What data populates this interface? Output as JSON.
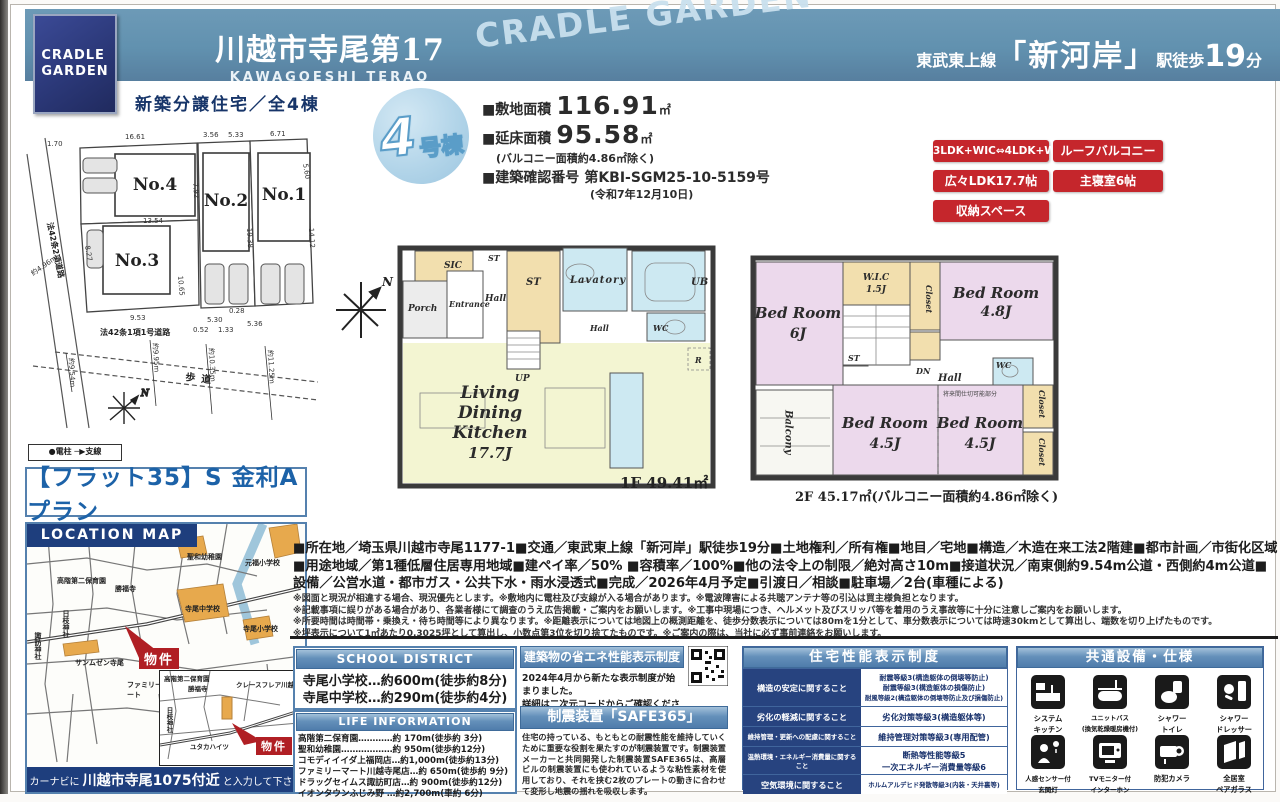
{
  "header": {
    "logo_line1": "CRADLE",
    "logo_line2": "GARDEN",
    "title": "川越市寺尾第17",
    "subtitle": "KAWAGOESHI TERAO",
    "watermark": "CRADLE GARDEN",
    "station_line": "東武東上線",
    "station_open": "「",
    "station_name": "新河岸",
    "station_close": "」",
    "station_walk": "駅徒歩",
    "station_min": "19",
    "station_min_unit": "分"
  },
  "subheader": "新築分譲住宅／全4棟",
  "unit_badge": {
    "number": "4",
    "suffix": "号棟"
  },
  "specs": {
    "land_label": "■敷地面積",
    "land_value": "116.91",
    "land_unit": "㎡",
    "floor_label": "■延床面積",
    "floor_value": "95.58",
    "floor_unit": "㎡",
    "balcony_note": "(バルコニー面積約4.86㎡除く)",
    "confirm_label": "■建築確認番号",
    "confirm_value": "第KBI-SGM25-10-5159号",
    "confirm_date": "(令和7年12月10日)"
  },
  "feature_badges": [
    "3LDK+WIC⇔4LDK+WIC",
    "ルーフバルコニー",
    "広々LDK17.7帖",
    "主寝室6帖",
    "収納スペース"
  ],
  "site_plan": {
    "lots": [
      "No.1",
      "No.2",
      "No.3",
      "No.4"
    ],
    "roads": [
      "法42条2項道路",
      "法42条1項1号道路",
      "歩道"
    ],
    "dims": {
      "d1": "1.70",
      "d2": "16.61",
      "d3": "3.56",
      "d4": "5.33",
      "d5": "6.71",
      "d6": "13.54",
      "d7": "7.92",
      "d8": "8.27",
      "d9": "10.65",
      "d10": "19.38",
      "d11": "14.12",
      "d12": "5.60",
      "d13": "9.53",
      "d14": "5.30",
      "d15": "0.52",
      "d16": "1.33",
      "d17": "5.36",
      "d18": "0.28",
      "w1": "約4.96m",
      "w2": "約9.54m",
      "w3": "約9.95m",
      "w4": "約10.35m",
      "w5": "約11.25m"
    },
    "legend": "●電柱 ─▶支線",
    "north": "N"
  },
  "flat35": "【フラット35】S 金利Aプラン",
  "location_map": {
    "header": "LOCATION MAP",
    "landmarks": {
      "l1": "聖和幼稚園",
      "l2": "元福小学校",
      "l3": "高階第二保育園",
      "l4": "勝福寺",
      "l5": "日枝神社",
      "l6": "諏訪神社",
      "l7": "サンムゼン寺尾",
      "l8": "寺尾中学校",
      "l9": "寺尾小学校",
      "l10": "ファミリーマート"
    },
    "inset": {
      "i1": "高階第二保育園",
      "i2": "勝福寺",
      "i3": "日枝神社",
      "i4": "クレースフレア川越",
      "i5": "ユタカハイツ"
    },
    "property": "物件",
    "navi_pre": "カーナビに ",
    "navi_addr": "川越市寺尾1075付近",
    "navi_post": " と入力して下さい"
  },
  "plan1f": {
    "label": "1F 49.41㎡",
    "rooms": {
      "sic": "SIC",
      "porch": "Porch",
      "entrance": "Entrance",
      "hall": "Hall",
      "st1": "ST",
      "st2": "ST",
      "lavatory": "Lavatory",
      "ub": "UB",
      "wc": "WC",
      "hall2": "Hall",
      "up": "UP",
      "r": "R",
      "ldk1": "Living",
      "ldk2": "Dining",
      "ldk3": "Kitchen",
      "ldk4": "17.7J"
    }
  },
  "plan2f": {
    "label": "2F 45.17㎡(バルコニー面積約4.86㎡除く)",
    "note": "将来間仕切可能部分",
    "rooms": {
      "br1a": "Bed Room",
      "br1b": "6J",
      "br2a": "Bed Room",
      "br2b": "4.8J",
      "br3a": "Bed Room",
      "br3b": "4.5J",
      "br4a": "Bed Room",
      "br4b": "4.5J",
      "wic": "W.I.C",
      "wic2": "1.5J",
      "closet1": "Closet",
      "closet2": "Closet",
      "closet3": "Closet",
      "st": "ST",
      "dn": "DN",
      "hall": "Hall",
      "wc": "WC",
      "balcony": "Balcony"
    }
  },
  "details": "■所在地／埼玉県川越市寺尾1177-1■交通／東武東上線「新河岸」駅徒歩19分■土地権利／所有権■地目／宅地■構造／木造在来工法2階建■都市計画／市街化区域■用途地域／第1種低層住居専用地域■建ペイ率／50% ■容積率／100%■他の法令上の制限／絶対高さ10m■接道状況／南東側約9.54m公道・西側約4m公道■設備／公営水道・都市ガス・公共下水・雨水浸透式■完成／2026年4月予定■引渡日／相談■駐車場／2台(車種による)",
  "notes": [
    "※図面と現況が相違する場合、現況優先とします。※敷地内に電柱及び支線が入る場合があります。※電波障害による共聴アンテナ等の引込は買主様負担となります。",
    "※記載事項に誤りがある場合があり、各業者様にて調査のうえ広告掲載・ご案内をお願いします。※工事中現場につき、ヘルメット及びスリッパ等を着用のうえ事故等に十分に注意しご案内をお願いします。",
    "※所要時間は時間帯・乗換え・待ち時間等により異なります。※距離表示については地図上の概測距離を、徒歩分数表示については80mを1分として、車分数表示については時速30kmとして算出し、端数を切り上げたものです。",
    "※坪表示について1㎡あたり0.3025坪として算出し、小数点第3位を切り捨てたものです。※ご案内の際は、当社に必ず事前連絡をお願いします。"
  ],
  "school": {
    "header": "SCHOOL DISTRICT",
    "rows": [
      "寺尾小学校…約600m(徒歩約8分)",
      "寺尾中学校…約290m(徒歩約4分)"
    ]
  },
  "life": {
    "header": "LIFE INFORMATION",
    "rows": [
      "高階第二保育園…………約 170m(徒歩約 3分)",
      "聖和幼稚園………………約 950m(徒歩約12分)",
      "コモディイイダ上福岡店…約1,000m(徒歩約13分)",
      "ファミリーマート川越寺尾店…約 650m(徒歩約 9分)",
      "ドラッグセイムス諏訪町店…約 900m(徒歩約12分)",
      "イオンタウンふじみ野 …約2,700m(車約 6分)"
    ]
  },
  "energy": {
    "header": "建築物の省エネ性能表示制度",
    "body1": "2024年4月から新たな表示制度が始まりました。",
    "body2": "詳細は二次元コードからご確認ください。"
  },
  "seismic": {
    "header": "制震装置「SAFE365」",
    "body": "住宅の持っている、もともとの耐震性能を維持していくために重要な役割を果たすのが制震装置です。制震装置メーカーと共同開発した制震装置SAFE365は、高層ビルの制震装置にも使われているような粘性素材を使用しており、それを挟む2枚のプレートの動きに合わせて変形し地震の揺れを吸収します。"
  },
  "performance": {
    "header": "住宅性能表示制度",
    "rows": [
      {
        "label": "構造の安定に関すること",
        "lines": [
          "耐震等級3(構造躯体の倒壊等防止)",
          "耐震等級3(構造躯体の損傷防止)",
          "耐風等級2(構造躯体の倒壊等防止及び損傷防止)"
        ]
      },
      {
        "label": "劣化の軽減に関すること",
        "lines": [
          "劣化対策等級3(構造躯体等)"
        ]
      },
      {
        "label": "維持管理・更新への配慮に関すること",
        "lines": [
          "維持管理対策等級3(専用配管)"
        ]
      },
      {
        "label": "温熱環境・エネルギー消費量に関すること",
        "lines": [
          "断熱等性能等級5",
          "一次エネルギー消費量等級6"
        ]
      },
      {
        "label": "空気環境に関すること",
        "lines": [
          "ホルムアルデヒド発散等級3(内装・天井裏等)"
        ]
      }
    ]
  },
  "equipment": {
    "header": "共通設備・仕様",
    "items": [
      {
        "icon": "system-kitchen-icon",
        "label1": "システム",
        "label2": "キッチン"
      },
      {
        "icon": "unit-bath-icon",
        "label1": "ユニットバス",
        "label2": "(換気乾燥暖房機付)"
      },
      {
        "icon": "shower-toilet-icon",
        "label1": "シャワー",
        "label2": "トイレ"
      },
      {
        "icon": "shower-dresser-icon",
        "label1": "シャワー",
        "label2": "ドレッサー"
      },
      {
        "icon": "sensor-light-icon",
        "label1": "人感センサー付",
        "label2": "玄関灯"
      },
      {
        "icon": "tv-interphone-icon",
        "label1": "TVモニター付",
        "label2": "インターホン"
      },
      {
        "icon": "security-camera-icon",
        "label1": "防犯カメラ",
        "label2": ""
      },
      {
        "icon": "pair-glass-icon",
        "label1": "全居室",
        "label2": "ペアガラス"
      }
    ]
  },
  "colors": {
    "banner": "#6191af",
    "navy": "#1e3e7d",
    "red": "#c5262c",
    "accent_border": "#5581ae"
  }
}
